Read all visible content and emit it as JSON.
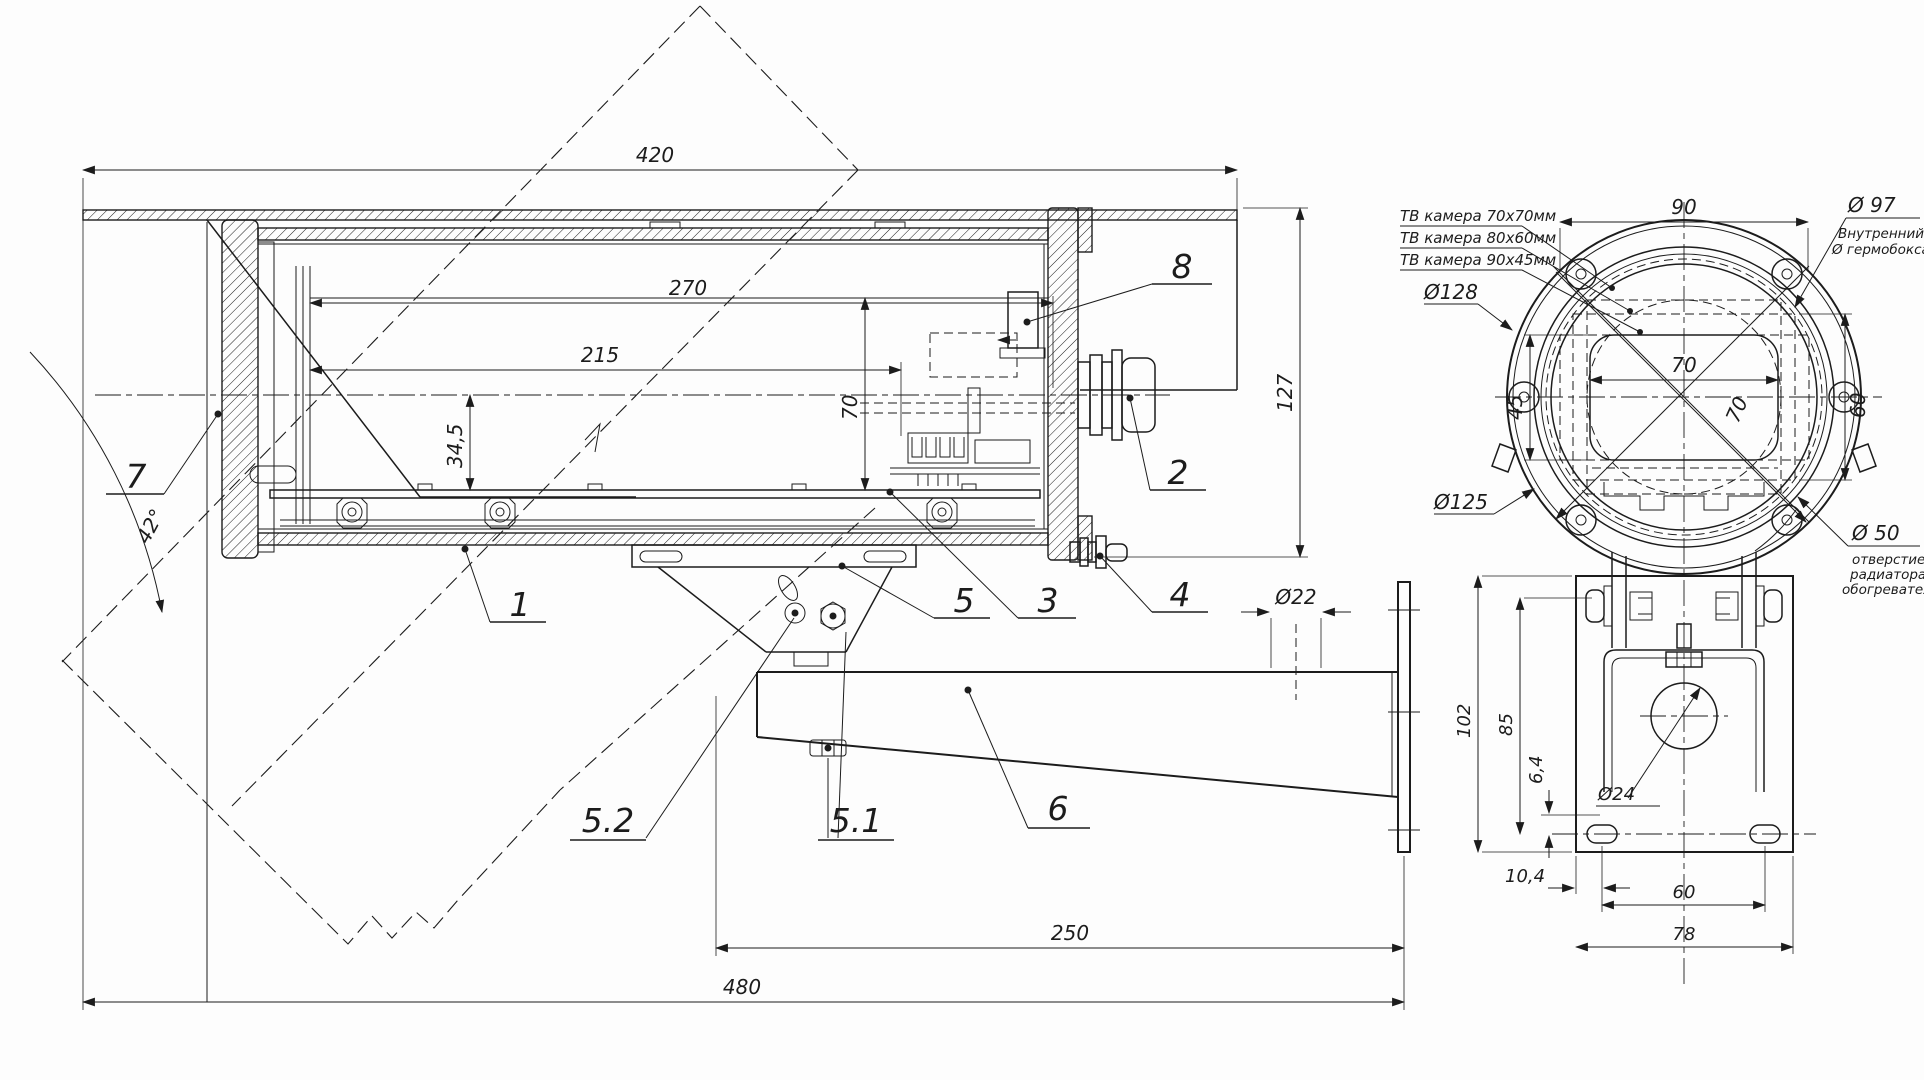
{
  "side_view": {
    "dim_420": "420",
    "dim_270": "270",
    "dim_215": "215",
    "dim_34_5": "34,5",
    "dim_70": "70",
    "dim_127": "127",
    "dim_42deg": "42°",
    "dim_d22": "Ø22",
    "dim_250": "250",
    "dim_480": "480",
    "callout_1": "1",
    "callout_2": "2",
    "callout_3": "3",
    "callout_4": "4",
    "callout_5": "5",
    "callout_5_1": "5.1",
    "callout_5_2": "5.2",
    "callout_6": "6",
    "callout_7": "7",
    "callout_8": "8"
  },
  "front_view": {
    "dim_90": "90",
    "dim_45": "45",
    "dim_60": "60",
    "dim_70_horizontal": "70",
    "dim_70_diagonal": "70",
    "label_d97": "Ø 97",
    "note_d97_line1": "Внутренний",
    "note_d97_line2": "Ø гермобокса",
    "label_d128": "Ø128",
    "label_d125": "Ø125",
    "label_d50": "Ø 50",
    "note_d50_line1": "отверстие",
    "note_d50_line2": "радиатора",
    "note_d50_line3": "обогревателя",
    "label_cam_70x70": "ТВ камера 70х70мм",
    "label_cam_80x60": "ТВ камера 80х60мм",
    "label_cam_90x45": "ТВ камера 90х45мм"
  },
  "bracket_view": {
    "dim_102": "102",
    "dim_85": "85",
    "dim_6_4": "6,4",
    "dim_10_4": "10,4",
    "dim_60": "60",
    "dim_78": "78",
    "label_d24": "Ø24"
  }
}
